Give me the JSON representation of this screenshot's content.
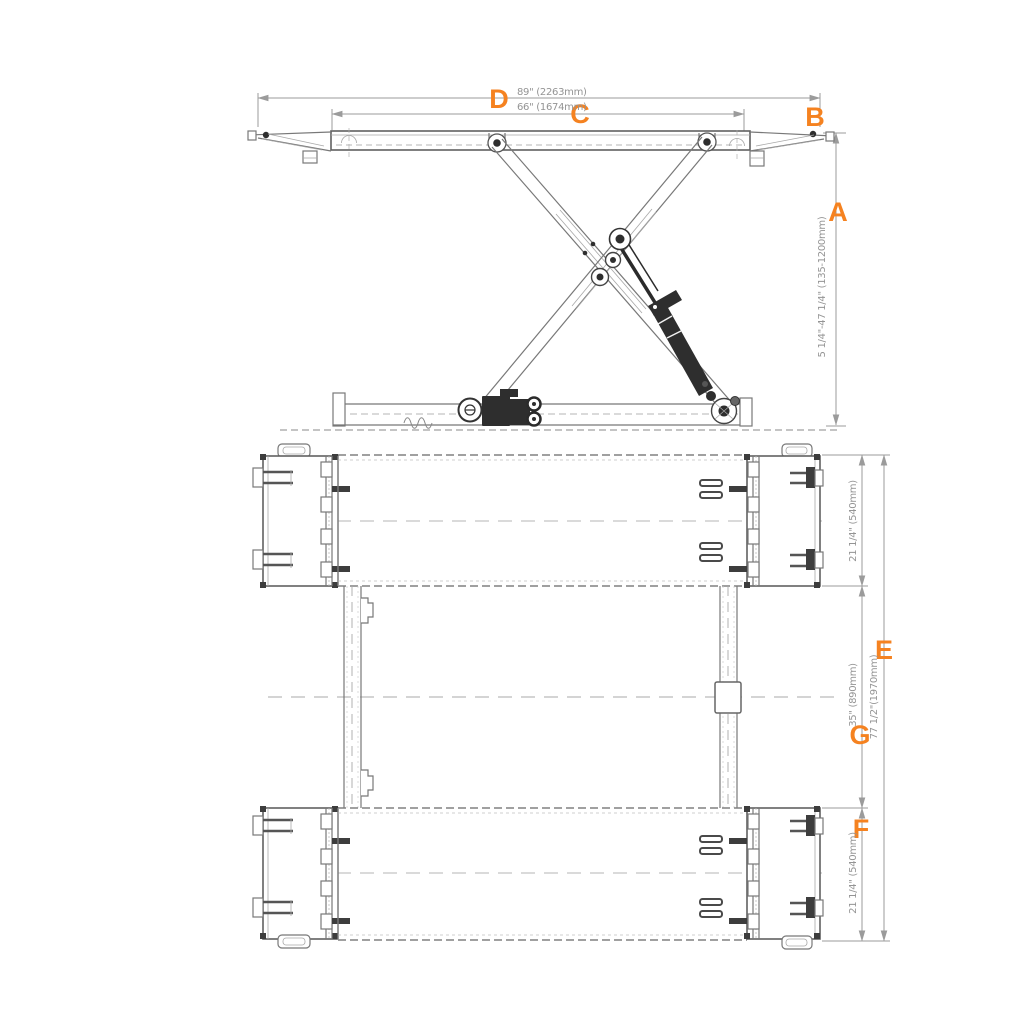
{
  "drawing": {
    "type": "scissor-lift-dimension-diagram",
    "accent_color": "#F58220",
    "line_color": "#787878",
    "dim_text_color": "#949494",
    "side_view": {
      "dim_d": {
        "label": "D",
        "value": "89\" (2263mm)"
      },
      "dim_c": {
        "label": "C",
        "value": "66\" (1674mm)"
      },
      "dim_b": {
        "label": "B"
      },
      "dim_a": {
        "label": "A",
        "value": "5 1/4\"-47 1/4\" (135-1200mm)"
      }
    },
    "plan_view": {
      "dim_top_width": {
        "value": "21 1/4\" (540mm)"
      },
      "dim_gap": {
        "label": "G",
        "value": "35\" (890mm)"
      },
      "dim_overall": {
        "label": "E",
        "value": "77 1/2\"(1970mm)"
      },
      "dim_bottom_width": {
        "label": "F",
        "value": "21 1/4\" (540mm)"
      }
    }
  }
}
